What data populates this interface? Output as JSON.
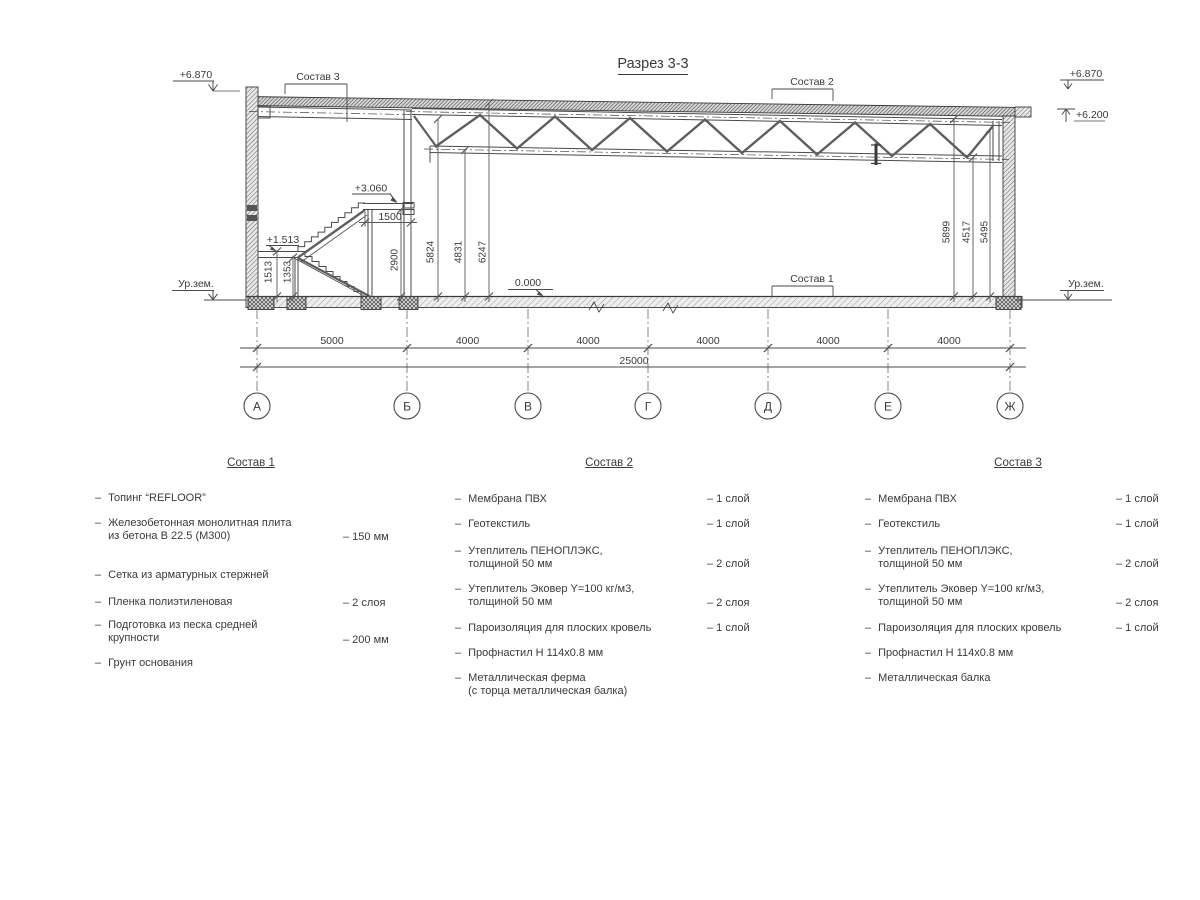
{
  "bullet": "–",
  "drawing": {
    "title": "Разрез 3-3",
    "leaders": {
      "s1": "Состав 1",
      "s2": "Состав 2",
      "s3": "Состав 3"
    },
    "elevations": {
      "left_top": "+6.870",
      "right_top": "+6.870",
      "right_low": "+6.200",
      "platform": "+3.060",
      "landing": "+1.513",
      "floor": "0.000"
    },
    "ground_left": "Ур.зем.",
    "ground_right": "Ур.зем.",
    "vdims": {
      "d1513": "1513",
      "d1353": "1353",
      "d2900": "2900",
      "d1500": "1500",
      "d5824": "5824",
      "d4831": "4831",
      "d6247": "6247",
      "d5899": "5899",
      "d4517": "4517",
      "d5495": "5495"
    },
    "spans": [
      "5000",
      "4000",
      "4000",
      "4000",
      "4000",
      "4000"
    ],
    "total": "25000",
    "axes": [
      "А",
      "Б",
      "В",
      "Г",
      "Д",
      "Е",
      "Ж"
    ]
  },
  "lists": [
    {
      "header": "Состав 1",
      "items": [
        {
          "line1": "Топинг “REFLOOR”"
        },
        {
          "line1": "Железобетонная  монолитная плита",
          "line2": "из бетона В 22.5 (М300)",
          "value": "– 150 мм"
        },
        {
          "line1": "Сетка из арматурных стержней"
        },
        {
          "line1": "Пленка полиэтиленовая",
          "value": "– 2 слоя"
        },
        {
          "line1": "Подготовка из песка средней",
          "line2": "крупности",
          "value": "– 200 мм"
        },
        {
          "line1": "Грунт основания"
        }
      ]
    },
    {
      "header": "Состав 2",
      "items": [
        {
          "line1": "Мембрана ПВХ",
          "value": "– 1 слой"
        },
        {
          "line1": "Геотекстиль",
          "value": "– 1 слой"
        },
        {
          "line1": "Утеплитель ПЕНОПЛЭКС,",
          "line2": "толщиной 50 мм",
          "value": "– 2 слой"
        },
        {
          "line1": "Утеплитель Эковер Y=100 кг/м3,",
          "line2": "толщиной 50 мм",
          "value": "– 2 слоя"
        },
        {
          "line1": "Пароизоляция для плоских кровель",
          "value": "– 1 слой"
        },
        {
          "line1": "Профнастил Н 114х0.8 мм"
        },
        {
          "line1": "Металлическая ферма",
          "line2": "(с торца металлическая балка)"
        }
      ]
    },
    {
      "header": "Состав 3",
      "items": [
        {
          "line1": "Мембрана ПВХ",
          "value": "– 1 слой"
        },
        {
          "line1": "Геотекстиль",
          "value": "– 1 слой"
        },
        {
          "line1": "Утеплитель ПЕНОПЛЭКС,",
          "line2": "толщиной 50 мм",
          "value": "– 2 слой"
        },
        {
          "line1": "Утеплитель Эковер Y=100 кг/м3,",
          "line2": "толщиной 50 мм",
          "value": "– 2 слоя"
        },
        {
          "line1": "Пароизоляция для плоских кровель",
          "value": "– 1 слой"
        },
        {
          "line1": "Профнастил Н 114х0.8 мм"
        },
        {
          "line1": "Металлическая балка"
        }
      ]
    }
  ]
}
